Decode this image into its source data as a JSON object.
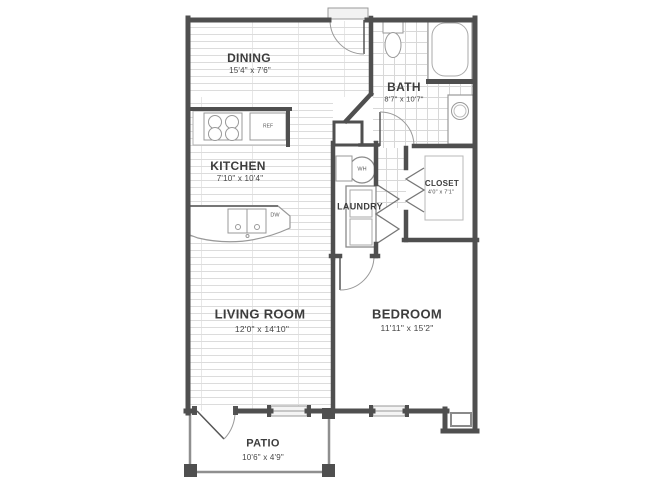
{
  "rooms": {
    "dining": {
      "label": "DINING",
      "dims": "15'4\" x 7'6\""
    },
    "bath": {
      "label": "BATH",
      "dims": "8'7\" x 10'7\""
    },
    "kitchen": {
      "label": "KITCHEN",
      "dims": "7'10\" x 10'4\""
    },
    "laundry": {
      "label": "LAUNDRY"
    },
    "closet": {
      "label": "CLOSET",
      "dims": "4'0\" x 7'1\""
    },
    "living_room": {
      "label": "LIVING ROOM",
      "dims": "12'0\" x 14'10\""
    },
    "bedroom": {
      "label": "BEDROOM",
      "dims": "11'11\" x 15'2\""
    },
    "patio": {
      "label": "PATIO",
      "dims": "10'6\" x 4'9\""
    }
  },
  "appliances": {
    "refrigerator": "REF",
    "dishwasher": "DW",
    "water_heater": "WH"
  },
  "colors": {
    "wall": "#4f4f4f",
    "fixture_line": "#999999",
    "plank_line": "#dcdcdc",
    "tile_line": "#d8d8d8",
    "text": "#3d3d3d"
  }
}
